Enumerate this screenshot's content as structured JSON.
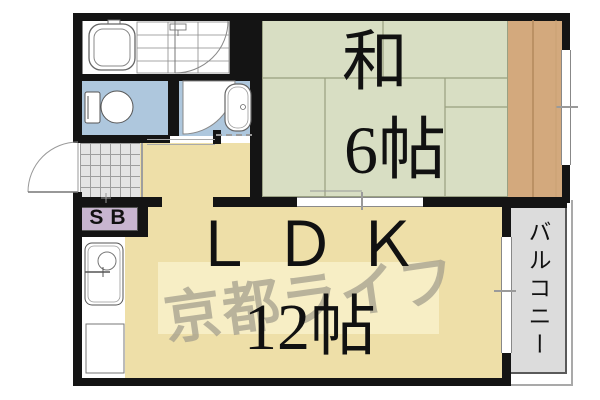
{
  "floorplan": {
    "rooms": {
      "washitsu": {
        "name": "和",
        "size": "6帖"
      },
      "ldk": {
        "name": "ＬＤＫ",
        "size": "12帖"
      },
      "balcony": {
        "label": "バルコニー"
      },
      "shoebox": {
        "label": "SB"
      }
    },
    "watermark": {
      "text": "京都ライフ"
    },
    "colors": {
      "wall": "#141414",
      "tatami": "#d8dec3",
      "ldk_floor": "#eedfa8",
      "water_room": "#aec7dd",
      "wood_strip": "#d3a97d",
      "balcony": "#dcdcdc",
      "tile": "#e4e4e4",
      "shoebox": "#c8b5d0",
      "watermark_band": "#f7efc8",
      "watermark_text": "#a29d8c",
      "line": "#777777"
    }
  }
}
